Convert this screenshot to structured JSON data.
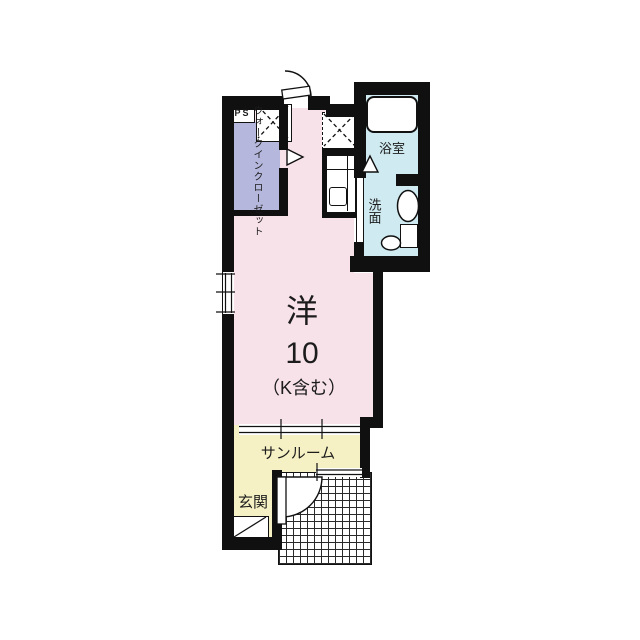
{
  "title": "1R apartment floor plan",
  "colors": {
    "wall": "#101010",
    "room-pink": "#f8e2ea",
    "closet-lavender": "#b5b7dc",
    "wet-blue": "#cfeaf0",
    "sun-yellow": "#f6f1c4"
  },
  "rooms": {
    "pipe_space": {
      "label": "PS"
    },
    "walk_in_closet": {
      "label_line1": "ウォークイン",
      "label_line2": "クローゼット"
    },
    "bathroom": {
      "label": "浴室"
    },
    "washroom": {
      "label": "洗面"
    },
    "main_room": {
      "type_label": "洋",
      "size_label": "10",
      "note_label": "（K含む）"
    },
    "sunroom": {
      "label": "サンルーム"
    },
    "entrance": {
      "label": "玄関"
    }
  }
}
